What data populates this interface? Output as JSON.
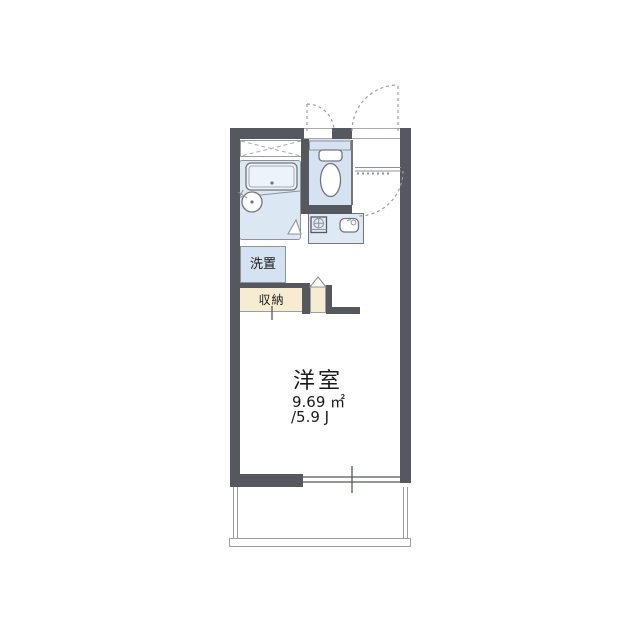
{
  "title": "apartment floor plan",
  "labels": {
    "washer_space": "洗置",
    "storage": "収納",
    "main_room_name": "洋室",
    "main_room_area_sqm": "9.69 ㎡",
    "main_room_area_tatami": "/5.9 J"
  },
  "icons": {
    "toilet": "toilet-icon",
    "bathtub": "bathtub-icon",
    "washbasin": "washbasin-icon",
    "stove": "stove-icon",
    "sink": "sink-icon",
    "door_swing": "door-swing-arc-icon",
    "door_triangle": "door-triangle-icon",
    "window": "sliding-window-icon",
    "cross_box": "crossed-area-icon"
  },
  "colors": {
    "wall": "#55585e",
    "outline": "#8f9297",
    "outline_light": "#a6a9ae",
    "blue": "#d5e2f1",
    "blue_panel": "#dbe7f3",
    "blue_counter": "#dfe9f4",
    "tub": "#edf3fa",
    "beige": "#f5ecd2",
    "dash": "#9a9da2",
    "fixture_stroke": "#72767c",
    "ink": "#1b1b1b"
  }
}
